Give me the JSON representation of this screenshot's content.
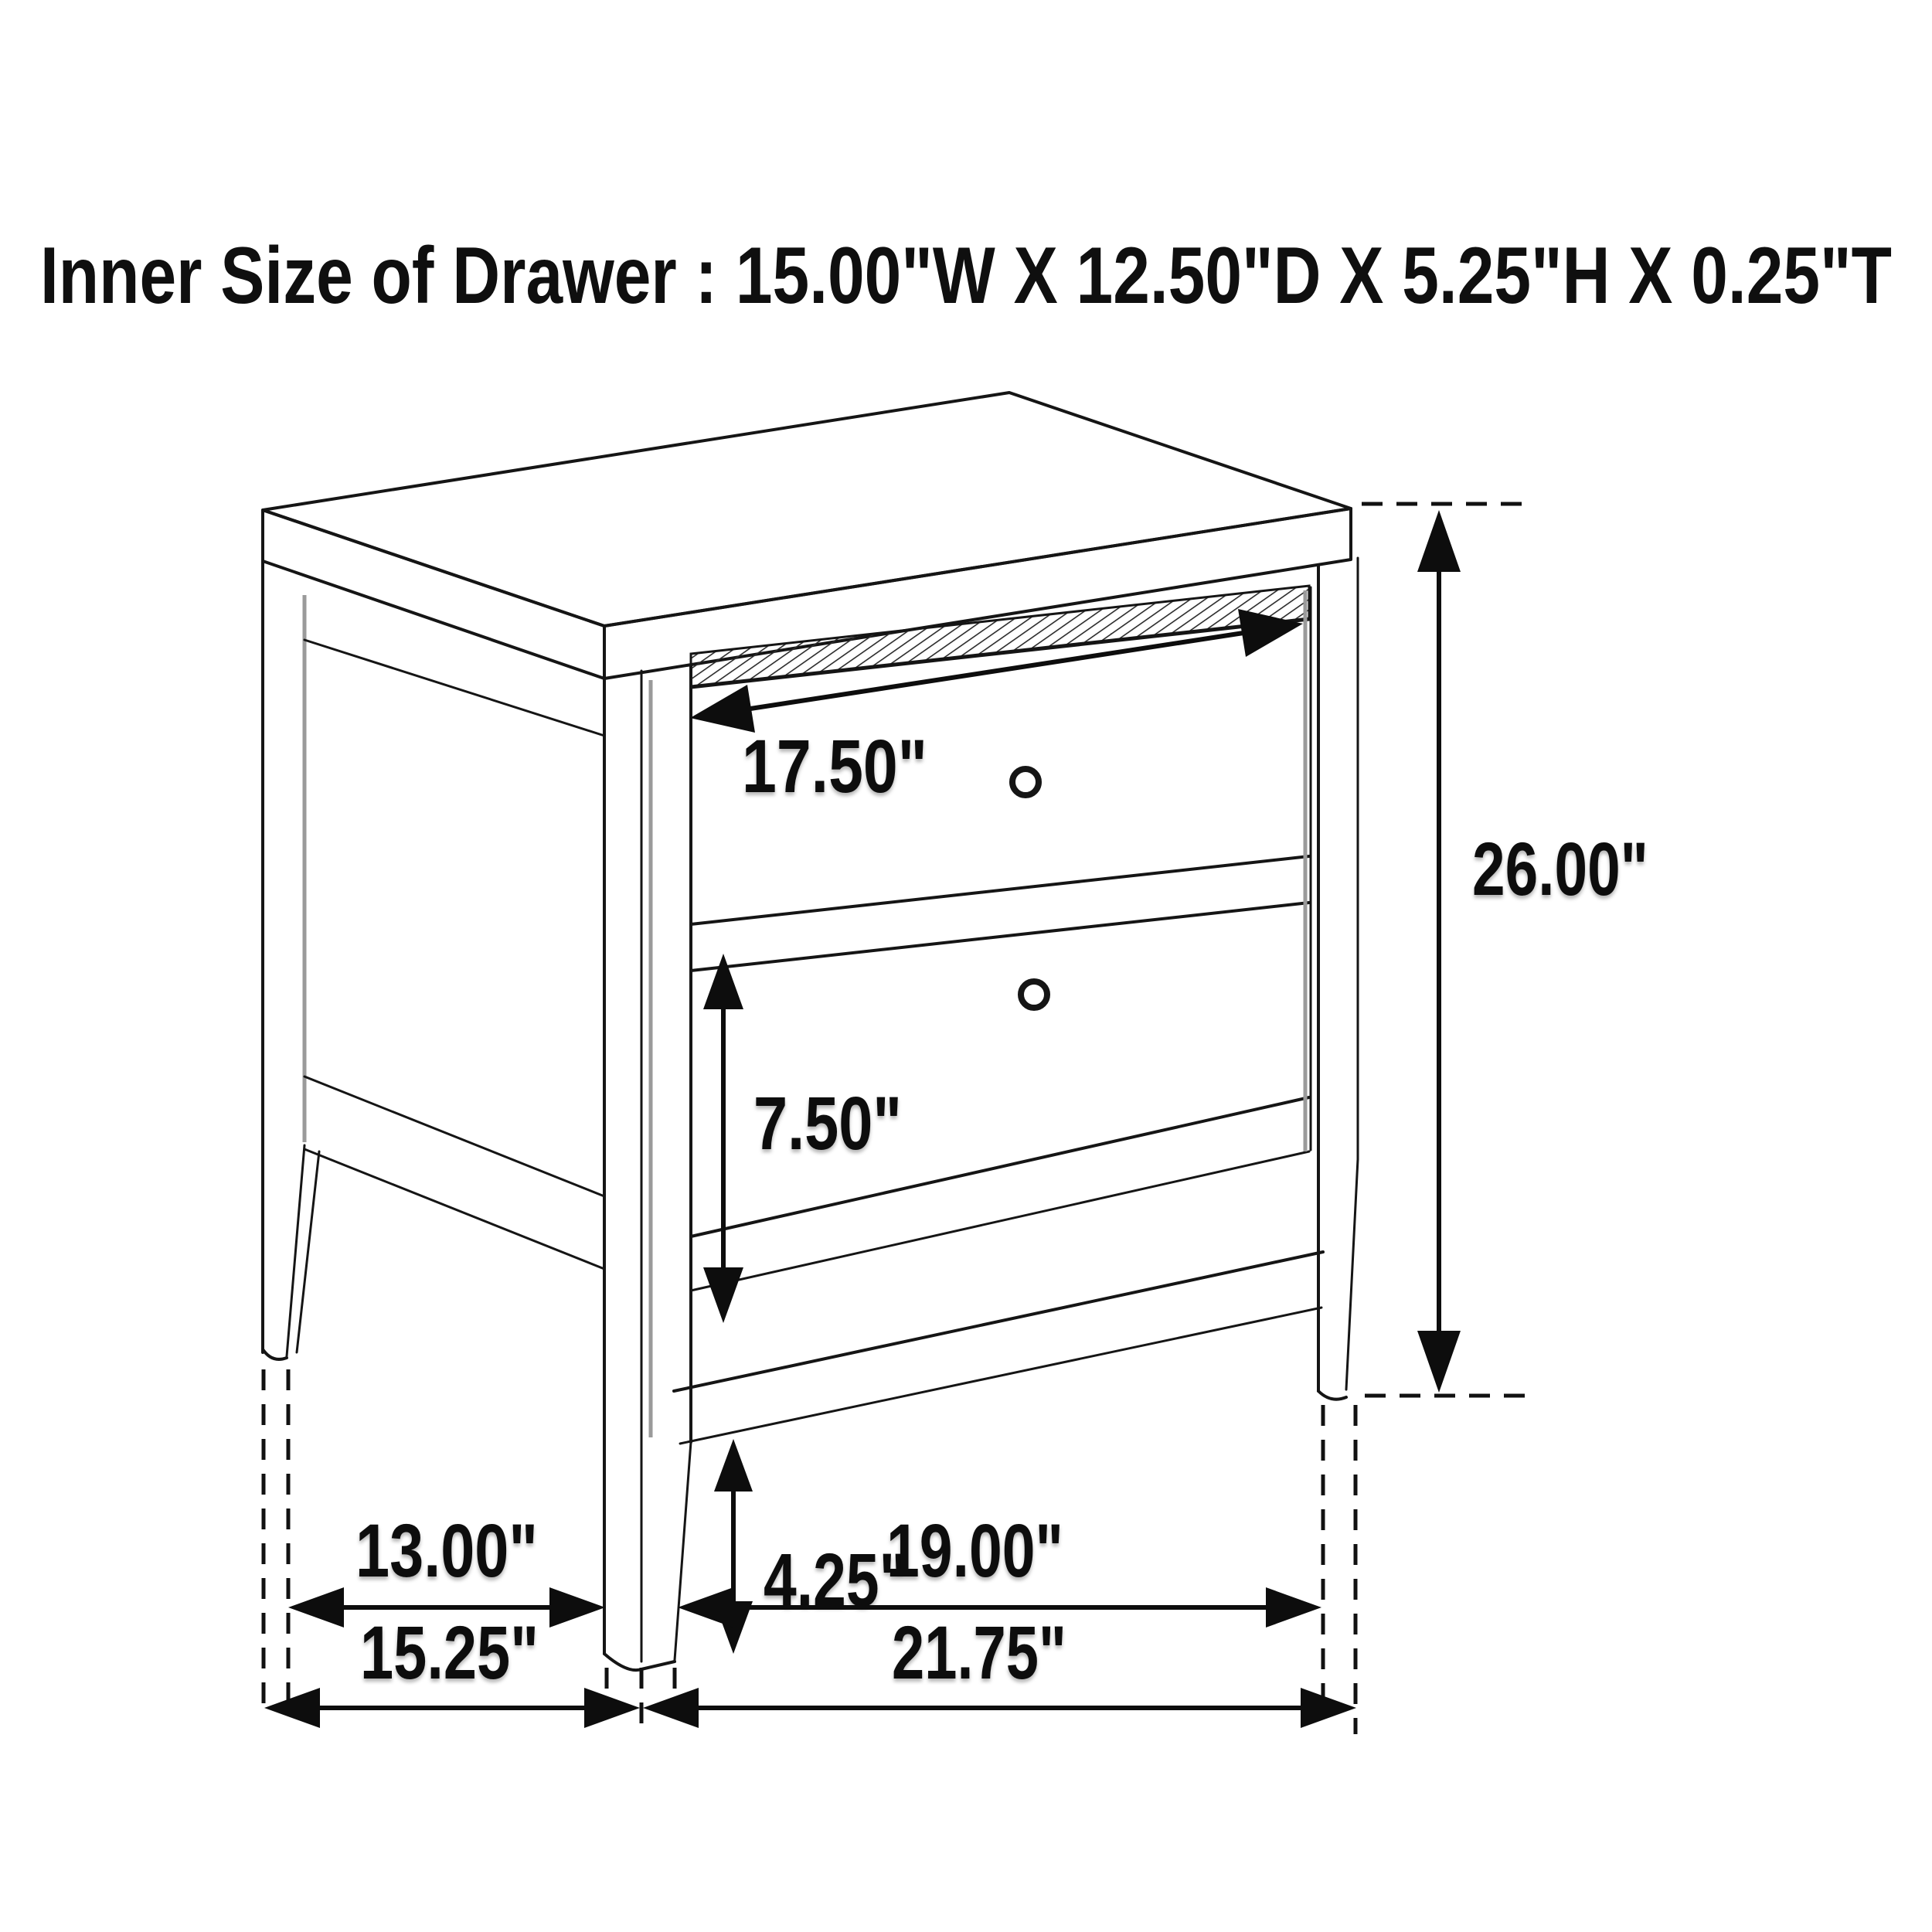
{
  "title": {
    "text": "Inner Size of Drawer : 15.00\"W X 12.50\"D X 5.25\"H X 0.25\"T"
  },
  "diagram": {
    "subject": "two-drawer nightstand line drawing",
    "view": "three-quarter front-left perspective",
    "background_color": "#ffffff",
    "ink_color": "#151515",
    "shading_color": "#9a9a9a",
    "drawer_count": 2,
    "knob_count": 2
  },
  "inner_size_of_drawer": {
    "width": "15.00\"W",
    "depth": "12.50\"D",
    "height": "5.25\"H",
    "thickness": "0.25\"T"
  },
  "dimensions": {
    "drawer_opening_width": {
      "label": "17.50\"",
      "orientation": "diagonal-across-top-drawer"
    },
    "overall_height": {
      "label": "26.00\"",
      "orientation": "vertical-right-side"
    },
    "bottom_drawer_height": {
      "label": "7.50\"",
      "orientation": "vertical-left-of-bottom-drawer"
    },
    "leg_clearance": {
      "label": "4.25\"",
      "orientation": "vertical-below-stretcher"
    },
    "side_leg_spacing": {
      "label": "13.00\"",
      "orientation": "horizontal-bottom-left"
    },
    "front_leg_spacing": {
      "label": "19.00\"",
      "orientation": "horizontal-bottom-right"
    },
    "overall_depth": {
      "label": "15.25\"",
      "orientation": "horizontal-bottom-left"
    },
    "overall_width": {
      "label": "21.75\"",
      "orientation": "horizontal-bottom-right"
    }
  }
}
